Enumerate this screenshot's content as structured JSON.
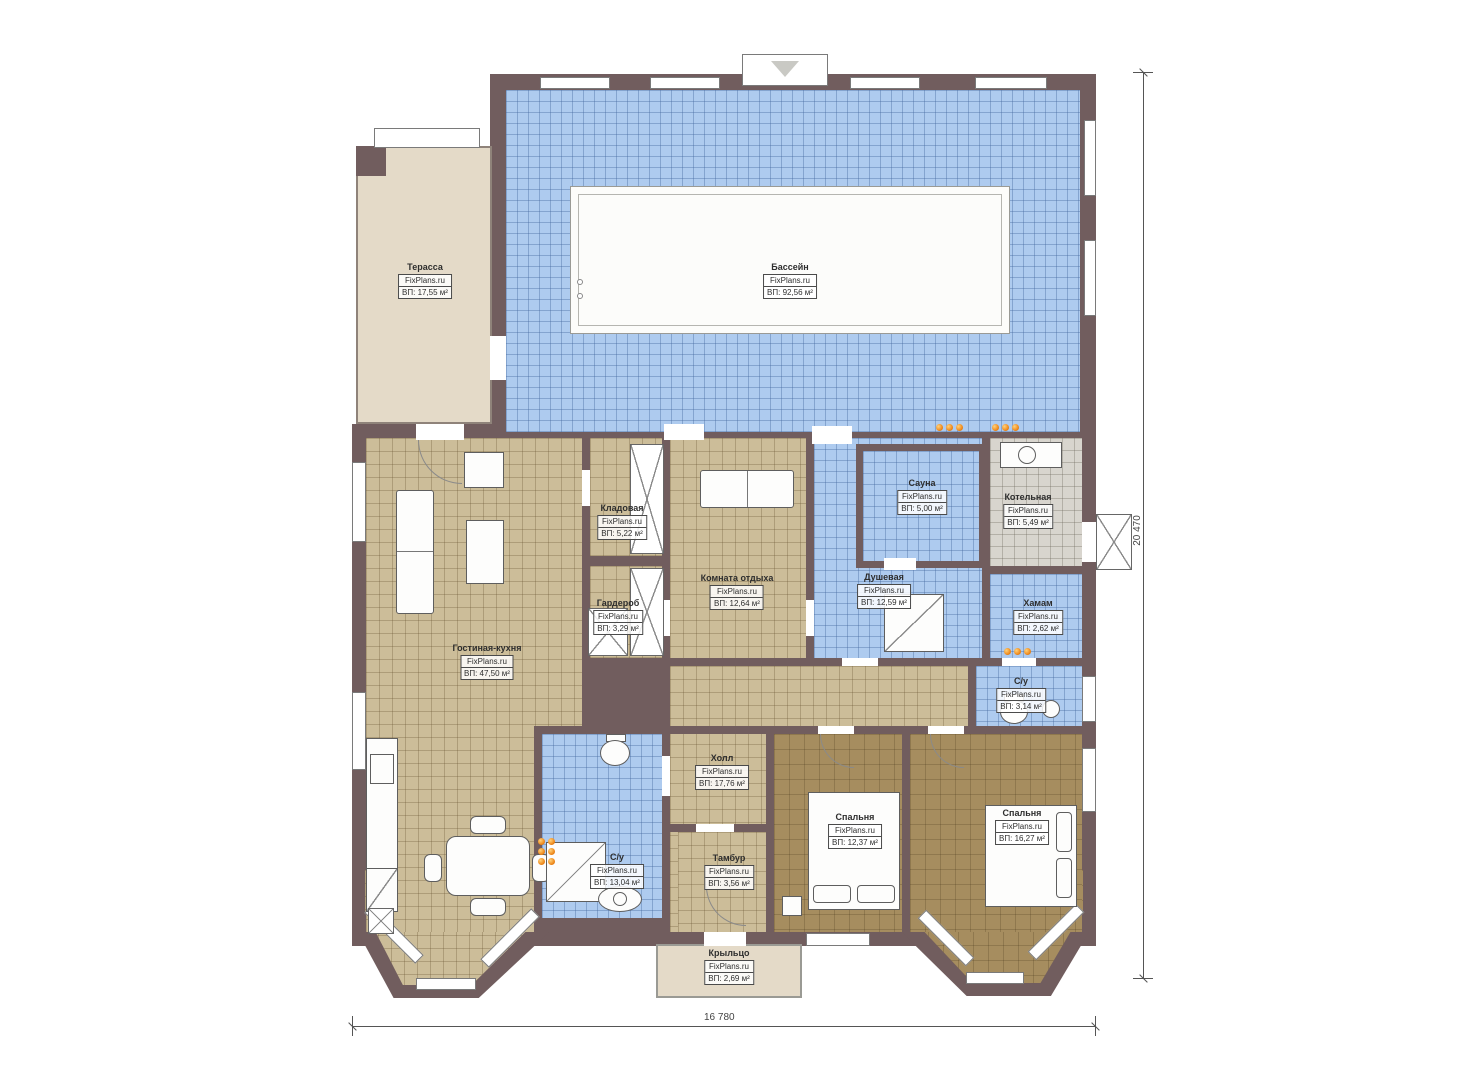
{
  "site": "FixPlans.ru",
  "rooms": [
    {
      "name": "Терасса",
      "area": "ВП: 17,55 м²"
    },
    {
      "name": "Бассейн",
      "area": "ВП: 92,56 м²"
    },
    {
      "name": "Кладовая",
      "area": "ВП: 5,22 м²"
    },
    {
      "name": "Гардероб",
      "area": "ВП: 3,29 м²"
    },
    {
      "name": "Комната отдыха",
      "area": "ВП: 12,64 м²"
    },
    {
      "name": "Сауна",
      "area": "ВП: 5,00 м²"
    },
    {
      "name": "Котельная",
      "area": "ВП: 5,49 м²"
    },
    {
      "name": "Душевая",
      "area": "ВП: 12,59 м²"
    },
    {
      "name": "Хамам",
      "area": "ВП: 2,62 м²"
    },
    {
      "name": "С/у",
      "area": "ВП: 3,14 м²"
    },
    {
      "name": "Гостиная-кухня",
      "area": "ВП: 47,50 м²"
    },
    {
      "name": "Холл",
      "area": "ВП: 17,76 м²"
    },
    {
      "name": "С/у",
      "area": "ВП: 13,04 м²"
    },
    {
      "name": "Тамбур",
      "area": "ВП: 3,56 м²"
    },
    {
      "name": "Спальня",
      "area": "ВП: 12,37 м²"
    },
    {
      "name": "Спальня",
      "area": "ВП: 16,27 м²"
    },
    {
      "name": "Крыльцо",
      "area": "ВП: 2,69 м²"
    }
  ],
  "dimensions": {
    "width_label": "16 780",
    "height_label": "20 470"
  },
  "colors": {
    "wall": "#715d5e",
    "wet_room_floor": "#aecbef",
    "living_floor": "#ccbd99",
    "bedroom_floor": "#a68d5f",
    "terrace_floor": "#e4dac8",
    "boiler_floor": "#d8d5ce",
    "radiator_dot": "#ef8a1e"
  }
}
